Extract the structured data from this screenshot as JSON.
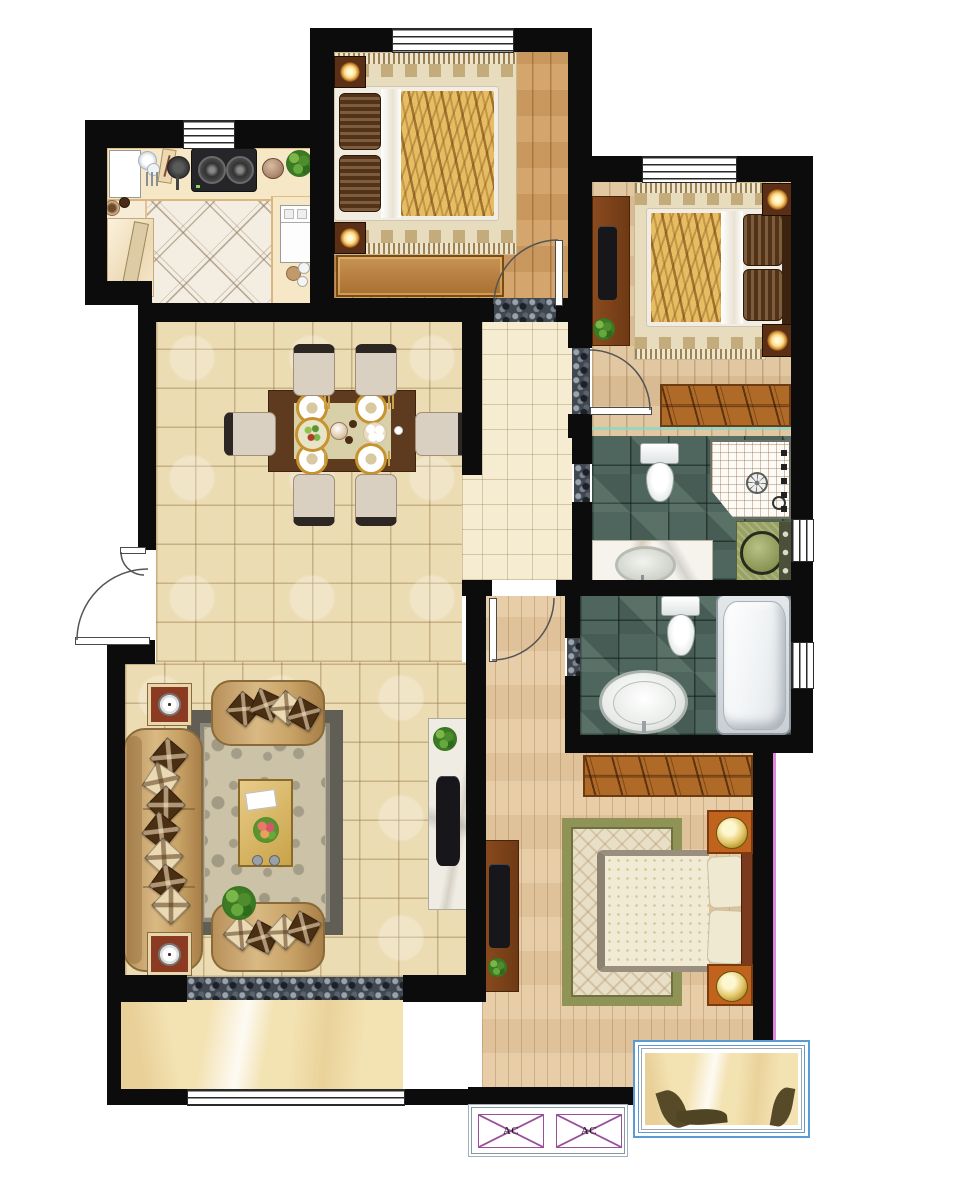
{
  "ac_units": [
    {
      "label": "AC"
    },
    {
      "label": "AC"
    }
  ],
  "palette": {
    "wall": "#0c0c0c",
    "living_tile": "#ecdcb4",
    "hall_tile": "#f5ecd2",
    "wood_bedroom_top": "#d1a065",
    "wood_bedroom_right": "#dfc49c",
    "wood_master": "#e5caa3",
    "bath_tile": "#4e665d",
    "kitchen_tile": "#f4eee2",
    "counter": "#f6e7c6",
    "balcony_marble": "#f3e2b2",
    "threshold_pebble": "#41474f",
    "window_frame_blue": "#5b9bd5",
    "ac_outline_purple": "#9a4f9a",
    "gold_accent": "#c8922e",
    "sofa_tan": "#c7a066",
    "wardrobe_wood": "#b06a28"
  }
}
